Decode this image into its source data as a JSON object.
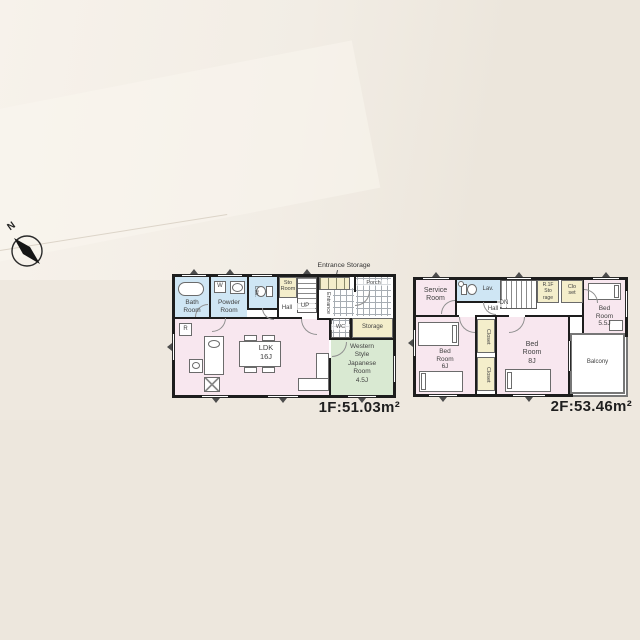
{
  "compass": {
    "north": "N"
  },
  "f1": {
    "callout": "Entrance Storage",
    "bath": "Bath\nRoom",
    "washer": "W",
    "powder": "Powder\nRoom",
    "lav": "Lav.",
    "sto": "Sto\nRoom",
    "up": "UP",
    "hall": "Hall",
    "entrance": "Entrance",
    "porch": "Porch",
    "fridge": "R",
    "ldk": "LDK\n16J",
    "wc": "WC",
    "storage": "Storage",
    "japanese": "Western\nStyle\nJapanese\nRoom\n4.5J",
    "area": "1F:51.03m²"
  },
  "f2": {
    "service": "Service\nRoom",
    "lav": "Lav.",
    "dn": "DN",
    "hall": "Hall",
    "stair_storage": "R.1F\nSto\nrage",
    "closet_small": "Clo\nset",
    "bed55": "Bed\nRoom\n5.5J",
    "bed6": "Bed\nRoom\n6J",
    "closet_a": "Closet",
    "closet_b": "Closet",
    "bed8": "Bed\nRoom\n8J",
    "balcony": "Balcony",
    "area": "2F:53.46m²"
  },
  "colors": {
    "background": "#efe9e0",
    "room_pink": "#f8e7ef",
    "room_blue": "#cfe6f4",
    "room_green": "#d9e9d2",
    "closet_yellow": "#f4eecb",
    "wall": "#1d1d1d"
  }
}
